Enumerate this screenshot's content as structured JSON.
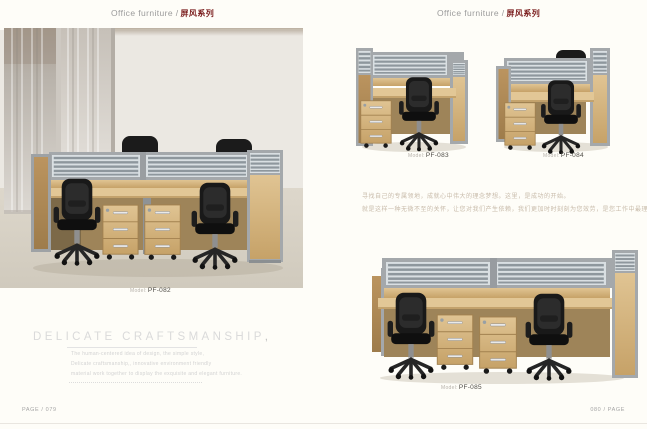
{
  "headers": {
    "left": {
      "en": "Office furniture /",
      "zh": "屏风系列"
    },
    "right": {
      "en": "Office furniture /",
      "zh": "屏风系列"
    }
  },
  "models": {
    "pf082": {
      "label": "Model:",
      "number": "PF-082"
    },
    "pf083": {
      "label": "Model:",
      "number": "PF-083"
    },
    "pf084": {
      "label": "Model:",
      "number": "PF-084"
    },
    "pf085": {
      "label": "Model:",
      "number": "PF-085"
    }
  },
  "headline": {
    "title": "DELICATE CRAFTSMANSHIP",
    "suffix": ","
  },
  "tagline": {
    "lines": [
      "The human-centered idea of design, the simple style,",
      "Delicate craftsmanship,, innovative environment friendly",
      "material work together to display the exquisite and elegant furniture."
    ]
  },
  "paragraph": {
    "lines": [
      "寻找自己的专属领地，成就心中伟大的理念梦想。这里，是成功的开始。",
      "就是这样一种无微不至的关怀，让您对我们产生依赖，我们更加时时刻刻为您效劳，是您工作中最理想的助手。"
    ]
  },
  "footers": {
    "left": "PAGE / 079",
    "right": "080 / PAGE"
  },
  "colors": {
    "accent_red": "#7b1e1e",
    "header_gray": "#9b9b9b",
    "wood": "#cfa96f",
    "frame_gray": "#a4a8ab",
    "chair_black": "#1a1a1a",
    "page_bg": "#fefdf8"
  },
  "photos": {
    "pf082": "four-seat screen workstation in showroom",
    "pf083": "single screen workstation",
    "pf084": "single screen workstation with rear seat",
    "pf085": "two-seat inline screen workstation"
  }
}
